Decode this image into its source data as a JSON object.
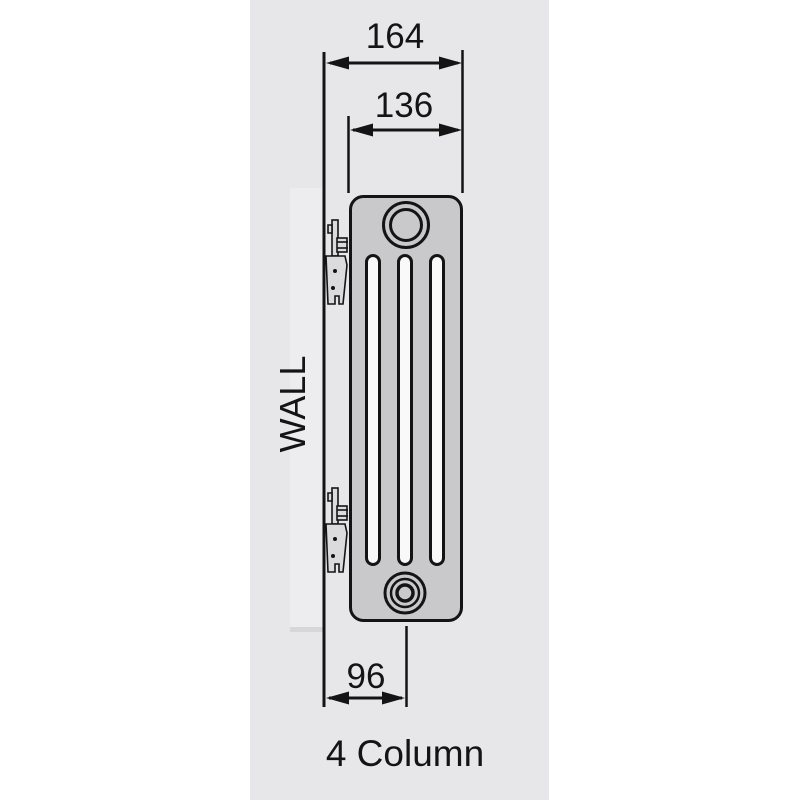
{
  "theme": {
    "page_bg": "#ffffff",
    "panel_bg": "#e7e7e9",
    "wall_bar_fill": "#ededef",
    "wall_bar_edge": "#d7d7d9",
    "line_color": "#141414",
    "radiator_fill": "#c9c9cb",
    "slot_fill": "#f9f9f9",
    "bracket_fill": "#dbdbdd",
    "text_color": "#141414"
  },
  "diagram": {
    "labels": {
      "top_width": "164",
      "inner_width": "136",
      "bottom_width": "96",
      "wall": "WALL",
      "caption": "4 Column"
    }
  }
}
